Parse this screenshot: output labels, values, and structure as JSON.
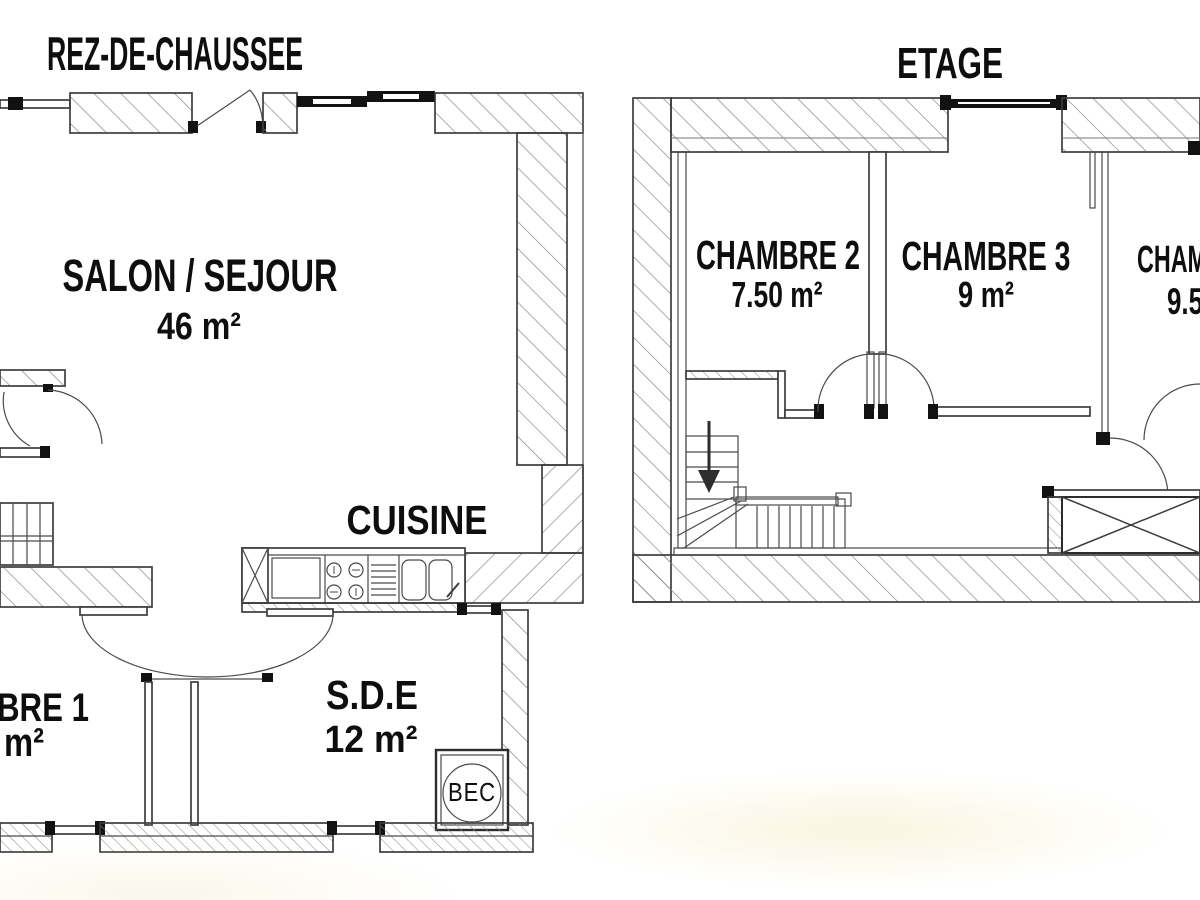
{
  "canvas": {
    "background": "#ffffff",
    "line_color": "#3d3d3d",
    "hatch_color": "#8a8a8a",
    "black_fill": "#121212",
    "text_color": "#0e0e0e"
  },
  "ground_floor": {
    "title": "REZ-DE-CHAUSSEE",
    "salon_name": "SALON / SEJOUR",
    "salon_area": "46 m²",
    "cuisine_name": "CUISINE",
    "sde_name": "S.D.E",
    "sde_area": "12 m²",
    "chambre1_name_partial": "BRE 1",
    "chambre1_area_partial": "m²",
    "water_heater_label": "BEC"
  },
  "upper_floor": {
    "title": "ETAGE",
    "chambre2_name": "CHAMBRE 2",
    "chambre2_area": "7.50 m²",
    "chambre3_name": "CHAMBRE 3",
    "chambre3_area": "9 m²",
    "chambre4_name_partial": "CHAM",
    "chambre4_area_partial": "9.5"
  }
}
